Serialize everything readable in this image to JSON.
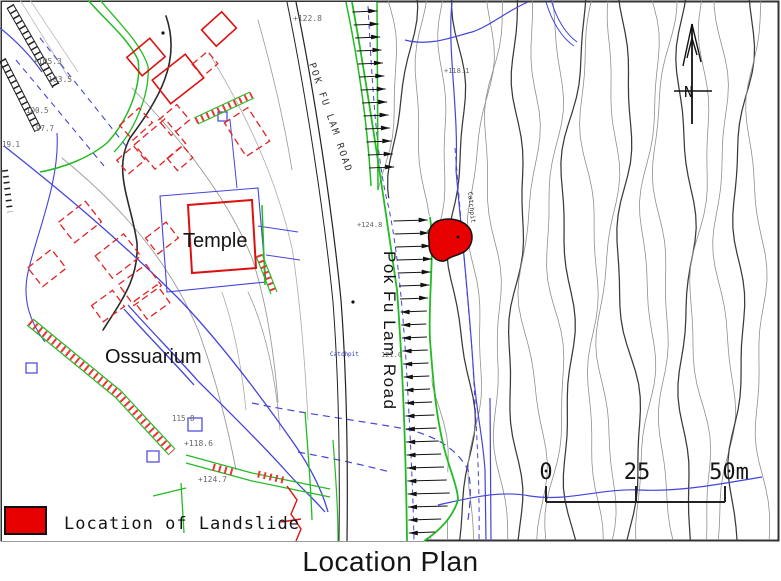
{
  "title": "Location Plan",
  "legend": {
    "swatch_color": "#e60000",
    "label": "Location of Landslide"
  },
  "scale_bar": {
    "tick_labels": [
      "0",
      "25",
      "50m"
    ]
  },
  "north_arrow": {
    "label": "N"
  },
  "map": {
    "labels": {
      "road_main": "Pok Fu Lam Road",
      "road_upper": "POK FU LAM ROAD",
      "temple": "Temple",
      "ossuarium": "Ossuarium",
      "catchpit_east": "Catchpit",
      "catchpit_west": "Catchpit"
    },
    "spot_heights": [
      "+122.8",
      "+124.8",
      "121.0",
      "+118.1",
      "115.8",
      "+118.6",
      "+124.7",
      "+105.3",
      "103.5",
      "100.5",
      "97.7",
      "19.1"
    ],
    "colors": {
      "landslide": "#e60000",
      "water": "#4444dd",
      "path_edge": "#22bb22",
      "building": "#dd1111",
      "contour": "#8a8a8a"
    }
  }
}
